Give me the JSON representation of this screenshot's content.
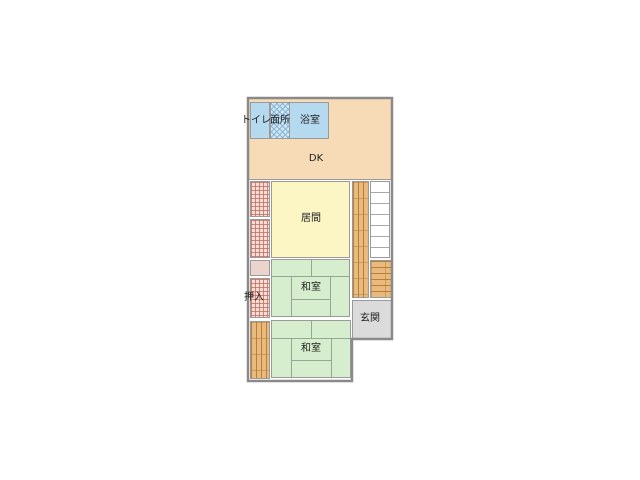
{
  "rooms": {
    "toilet": "トイレ",
    "washroom": "面所",
    "bathroom": "浴室",
    "dining_kitchen": "DK",
    "living_room": "居間",
    "tatami_room_upper": "和室",
    "tatami_room_lower": "和室",
    "closet": "押入",
    "entrance": "玄関"
  },
  "features": {
    "stairs_step_count": 7
  },
  "colors": {
    "wall": "#8a8a8a",
    "water_rooms": "#b5d9ee",
    "washroom_hatch": "#80b2d6",
    "dining_kitchen": "#f7dab6",
    "living_room": "#fcf6c5",
    "tatami_room": "#d6eecd",
    "closet_hatch": "#c67364",
    "closet_bg": "#f6ded6",
    "storage_pink": "#ecd4cc",
    "wood_floor": "#e9ba7d",
    "wood_grain": "#b07430",
    "entrance": "#dbdbdb",
    "stairs": "#ffffff",
    "background": "#ffffff"
  }
}
